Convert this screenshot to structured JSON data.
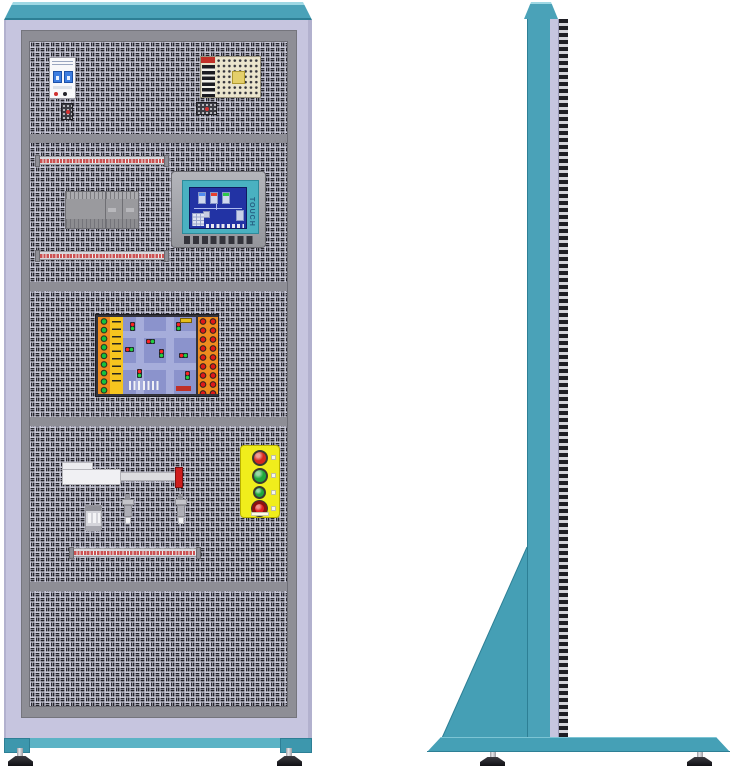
{
  "scene": {
    "title": "Electrical PLC training cabinet - front and side views",
    "front_view_label": "front view",
    "side_view_label": "side view"
  },
  "palette": {
    "teal": "#4aa2b8",
    "teal_light": "#9ed8e4",
    "teal_dark": "#2d7f95",
    "teal_base_block": "#3d97ad",
    "lavender": "#c6c5df",
    "frame_gray": "#8e8e96",
    "panel_bg": "#c9c9d8",
    "panel_slot": "#24242c",
    "terminal_red": "#cc5252",
    "board_orange": "#ef8b1e",
    "board_yellow": "#f6c51f",
    "board_blue": "#8b93cc",
    "button_yellow": "#f0ed1c"
  },
  "hmi": {
    "side_label": "TOUCH",
    "screen_color": "#2233a4",
    "tank_colors": [
      "#4f8cf0",
      "#e8402e",
      "#2ec84a"
    ]
  },
  "button_panel": {
    "buttons": [
      {
        "name": "red-pushbutton",
        "color": "#d8281e"
      },
      {
        "name": "green-pushbutton",
        "color": "#1fa83c"
      },
      {
        "name": "small-green-pushbutton",
        "color": "#1fa83c"
      },
      {
        "name": "emergency-stop",
        "color": "#e02020"
      }
    ]
  },
  "traffic_board": {
    "left_led_color": "#15c23e",
    "right_led_color": "#e01818"
  },
  "actuator": {
    "tip_color": "#cf1d1d"
  }
}
